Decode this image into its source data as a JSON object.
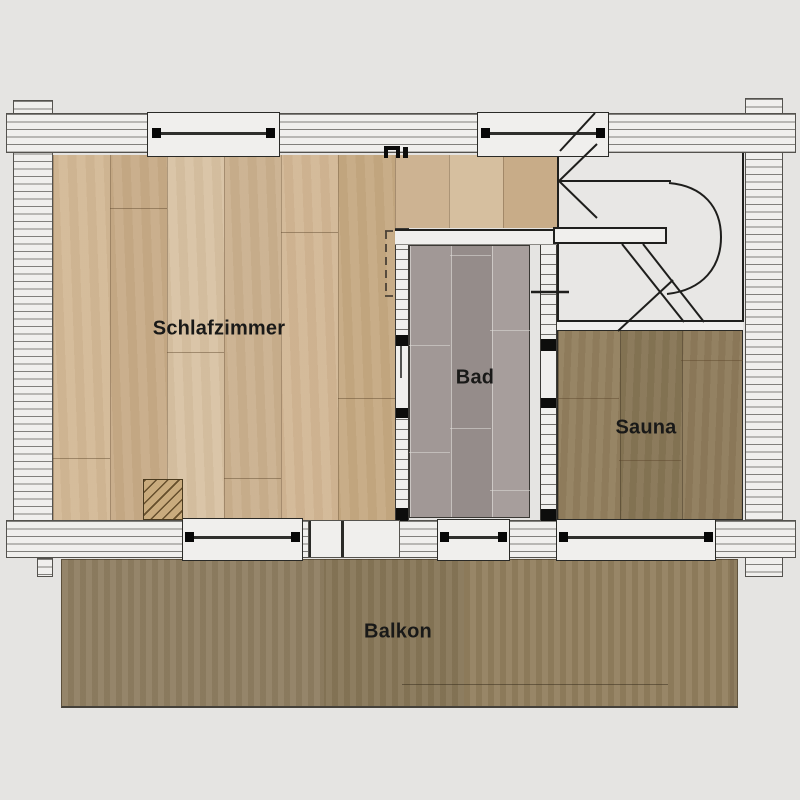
{
  "rooms": {
    "schlafzimmer": {
      "label": "Schlafzimmer"
    },
    "bad": {
      "label": "Bad"
    },
    "sauna": {
      "label": "Sauna"
    },
    "balkon": {
      "label": "Balkon"
    }
  },
  "colors": {
    "background": "#e5e4e2",
    "wall_fill": "#f0efed",
    "bedroom_floor": "#ceb493",
    "bath_floor": "#9d9492",
    "sauna_floor": "#8d7c5e",
    "balcony_floor": "#8c7b5f",
    "line": "#1e1e1c",
    "window_marker": "#070707"
  }
}
